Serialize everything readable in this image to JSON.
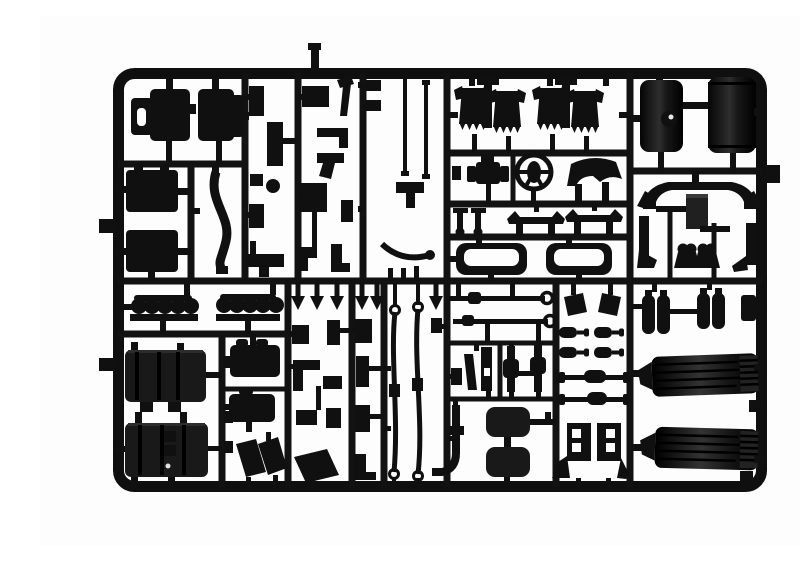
{
  "scene": {
    "description": "Top-down photograph of a black injection-moulded plastic model kit sprue (parts tree) of truck model parts on a white background",
    "background_color": "#fdfdfd",
    "plastic_color": "#101010",
    "frame_shape": "rounded rectangle runner frame with internal grid of runners dividing compartments",
    "visible_text": "none"
  },
  "sprue": {
    "outer_bounds_px": {
      "left": 73,
      "top": 52,
      "right": 727,
      "bottom": 476
    },
    "ejector_tabs": [
      "left edge upper",
      "left edge lower",
      "right edge upper",
      "top edge stub"
    ]
  },
  "parts_inventory": [
    {
      "id": "cab-door-panels",
      "label": "cab door panels",
      "count": 2,
      "area": "top-left"
    },
    {
      "id": "cab-floor-panels",
      "label": "cab floor panels",
      "count": 2,
      "area": "left"
    },
    {
      "id": "curved-brace",
      "label": "curved chassis brace",
      "count": 1,
      "area": "left"
    },
    {
      "id": "small-fittings",
      "label": "assorted small brackets, levers and fittings",
      "count": 18,
      "area": "upper middle"
    },
    {
      "id": "antenna-rods",
      "label": "thin rods / antennas",
      "count": 2,
      "area": "upper middle"
    },
    {
      "id": "seat-backs",
      "label": "cab seat backs with connectors",
      "count": 4,
      "area": "top center"
    },
    {
      "id": "seat-base",
      "label": "seat base with armrests",
      "count": 1,
      "area": "center"
    },
    {
      "id": "steering-wheel",
      "label": "steering wheel",
      "count": 1,
      "area": "center"
    },
    {
      "id": "dashboard-cowl",
      "label": "dashboard cowl",
      "count": 1,
      "area": "center"
    },
    {
      "id": "grab-rails",
      "label": "grab rails with legs",
      "count": 2,
      "area": "center"
    },
    {
      "id": "mushroom-posts",
      "label": "mushroom head posts",
      "count": 2,
      "area": "center"
    },
    {
      "id": "storage-trays",
      "label": "open storage trays",
      "count": 2,
      "area": "center"
    },
    {
      "id": "fuel-tanks",
      "label": "cylindrical fuel tanks, one with filler cap",
      "count": 2,
      "area": "top right"
    },
    {
      "id": "bumper-arch",
      "label": "arched bumper / light-bar bracket",
      "count": 1,
      "area": "right"
    },
    {
      "id": "panel-plate",
      "label": "flat rectangular plate",
      "count": 1,
      "area": "right"
    },
    {
      "id": "step-brackets",
      "label": "mirrored step brackets and paw-shaped mounts",
      "count": 4,
      "area": "right"
    },
    {
      "id": "cylinder-rows",
      "label": "rows of round knobs on base strips",
      "count": 2,
      "area": "lower left"
    },
    {
      "id": "battery-boxes",
      "label": "ribbed battery / tool boxes",
      "count": 2,
      "area": "lower left"
    },
    {
      "id": "gearbox-halves",
      "label": "gearbox half blocks",
      "count": 2,
      "area": "lower left"
    },
    {
      "id": "mud-flaps",
      "label": "angled mud flaps",
      "count": 4,
      "area": "lower left"
    },
    {
      "id": "arrow-pins",
      "label": "arrow-head fastener pins",
      "count": 7,
      "area": "lower middle"
    },
    {
      "id": "leaf-springs",
      "label": "long leaf springs with end eyes",
      "count": 2,
      "area": "lower middle"
    },
    {
      "id": "tie-rods",
      "label": "long tie rods with ring ends",
      "count": 2,
      "area": "lower middle"
    },
    {
      "id": "suspension-links",
      "label": "vertical suspension links",
      "count": 5,
      "area": "lower middle"
    },
    {
      "id": "exhaust-downpipe",
      "label": "curved exhaust downpipe",
      "count": 1,
      "area": "lower middle"
    },
    {
      "id": "air-tanks-square",
      "label": "rounded square air tanks",
      "count": 2,
      "area": "lower middle"
    },
    {
      "id": "shock-absorbers",
      "label": "shock absorbers",
      "count": 4,
      "area": "lower middle"
    },
    {
      "id": "axle-rods",
      "label": "axle rods with center cylinders",
      "count": 2,
      "area": "lower middle"
    },
    {
      "id": "boot-brackets",
      "label": "mirrored chassis boot brackets with holes",
      "count": 2,
      "area": "lower middle"
    },
    {
      "id": "air-reservoirs",
      "label": "paired cylindrical air reservoirs",
      "count": 4,
      "area": "lower right"
    },
    {
      "id": "mudguards",
      "label": "large ribbed mudguards",
      "count": 2,
      "area": "lower right"
    }
  ]
}
